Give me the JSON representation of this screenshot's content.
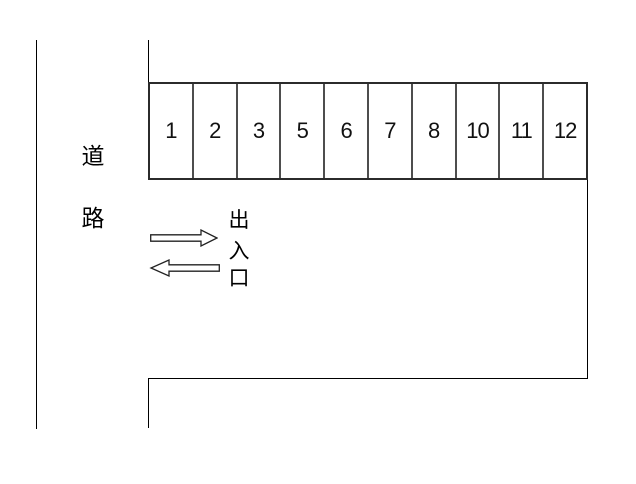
{
  "diagram": {
    "type": "parking-lot-layout",
    "background_color": "#ffffff",
    "line_color": "#000000",
    "stall_border_color": "#2b2b2b",
    "stall_divider_color": "#4e4e4e",
    "arrow_fill_color": "#ffffff"
  },
  "road": {
    "word": "道路",
    "chars": [
      "道",
      "路"
    ]
  },
  "stalls": {
    "numbers": [
      "1",
      "2",
      "3",
      "5",
      "6",
      "7",
      "8",
      "10",
      "11",
      "12"
    ]
  },
  "gate": {
    "word": "出入口",
    "chars": [
      "出",
      "入",
      "口"
    ],
    "arrows": [
      "right",
      "left"
    ]
  }
}
